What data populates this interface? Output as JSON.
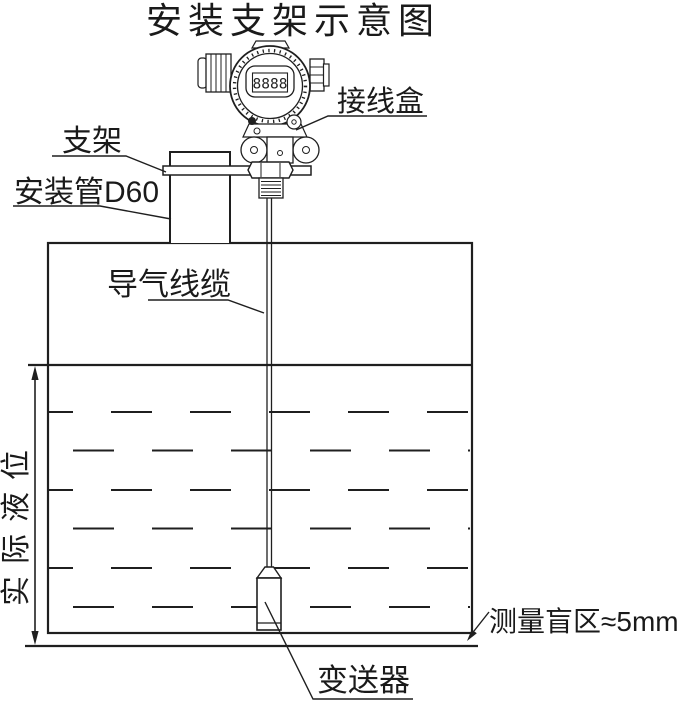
{
  "title": "安装支架示意图",
  "labels": {
    "junction_box": "接线盒",
    "bracket": "支架",
    "mounting_pipe": "安装管D60",
    "air_cable": "导气线缆",
    "actual_level": "实际液位",
    "blind_zone": "测量盲区≈5mm",
    "transmitter": "变送器"
  },
  "display": {
    "lcd_value": "8888"
  },
  "colors": {
    "line": "#1f1f1f",
    "background": "#ffffff"
  }
}
